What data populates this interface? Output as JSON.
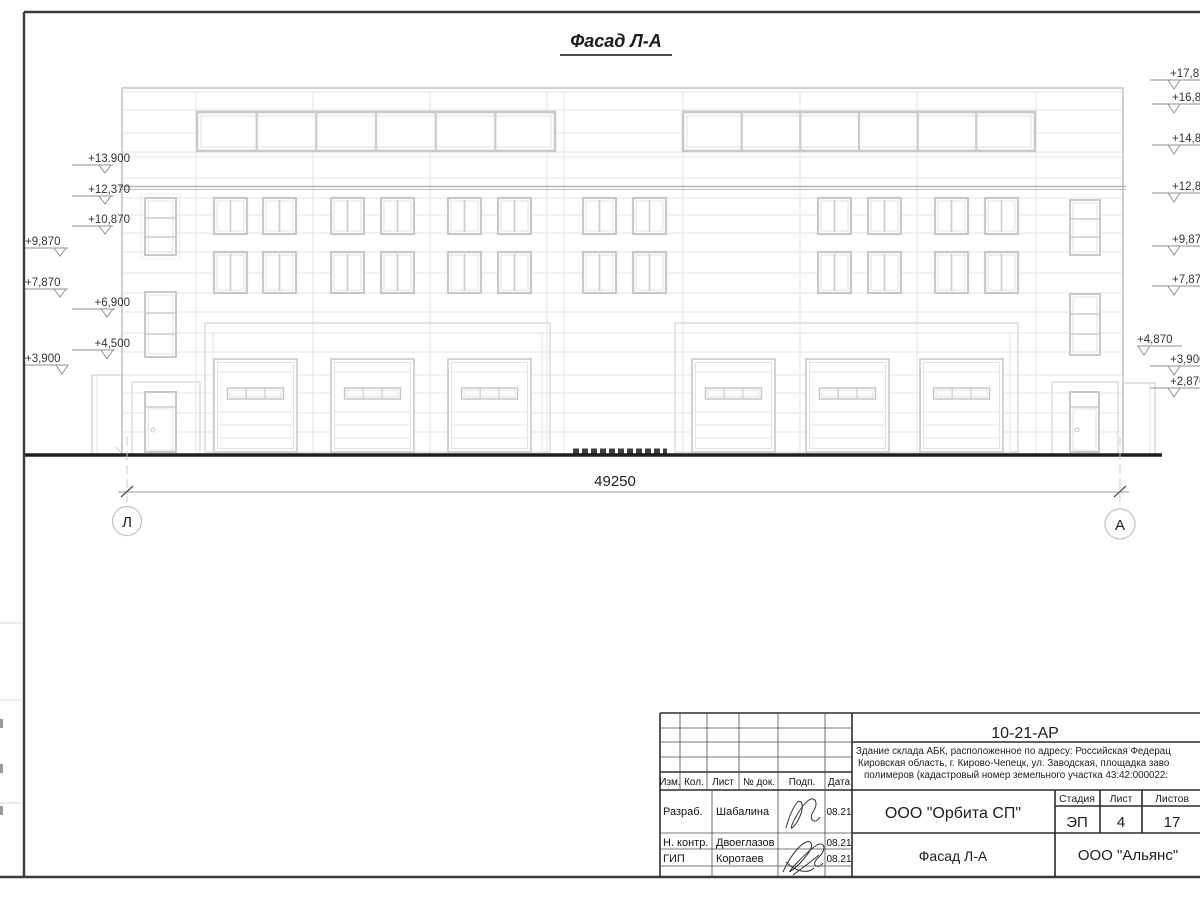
{
  "sheet": {
    "title": "Фасад Л-А"
  },
  "dimension": {
    "value": "49250",
    "axis_left": "Л",
    "axis_right": "А"
  },
  "elevation_marks": {
    "left": [
      {
        "label": "+13.900"
      },
      {
        "label": "+12,370"
      },
      {
        "label": "+10,870"
      },
      {
        "label": "+9,870"
      },
      {
        "label": "+7,870"
      },
      {
        "label": "+6,900"
      },
      {
        "label": "+4,500"
      },
      {
        "label": "+3,900"
      }
    ],
    "right": [
      {
        "label": "+17,870"
      },
      {
        "label": "+16,870"
      },
      {
        "label": "+14,870"
      },
      {
        "label": "+12,870"
      },
      {
        "label": "+9,870"
      },
      {
        "label": "+7,870"
      },
      {
        "label": "+4,870"
      },
      {
        "label": "+3,900"
      },
      {
        "label": "+2,870"
      }
    ]
  },
  "title_block": {
    "doc_number": "10-21-АР",
    "description_lines": [
      "Здание склада АБК, расположенное по адресу: Российская Федерац",
      "Кировская область, г. Кирово-Чепецк, ул. Заводская, площадка заво",
      "полимеров (кадастровый номер земельного участка 43:42:000022:"
    ],
    "columns": {
      "izm": "Изм.",
      "kol": "Кол.",
      "list": "Лист",
      "doc": "№ док.",
      "podp": "Подп.",
      "data": "Дата"
    },
    "rows": [
      {
        "role": "Разраб.",
        "name": "Шабалина",
        "date": "08.21"
      },
      {
        "role": "Н. контр.",
        "name": "Двоеглазов",
        "date": "08.21"
      },
      {
        "role": "ГИП",
        "name": "Коротаев",
        "date": "08.21"
      }
    ],
    "company": "ООО \"Орбита СП\"",
    "stage_label": "Стадия",
    "sheet_label": "Лист",
    "sheets_label": "Листов",
    "stage": "ЭП",
    "sheet_number": "4",
    "sheets_total": "17",
    "drawing_name": "Фасад Л-А",
    "contractor": "ООО \"Альянс\""
  },
  "colors": {
    "facade_line": "#e3e3e3",
    "window_frame": "#c8c8c8",
    "ground_line": "#1f1f1f",
    "frame_line": "#3a3a3a"
  }
}
